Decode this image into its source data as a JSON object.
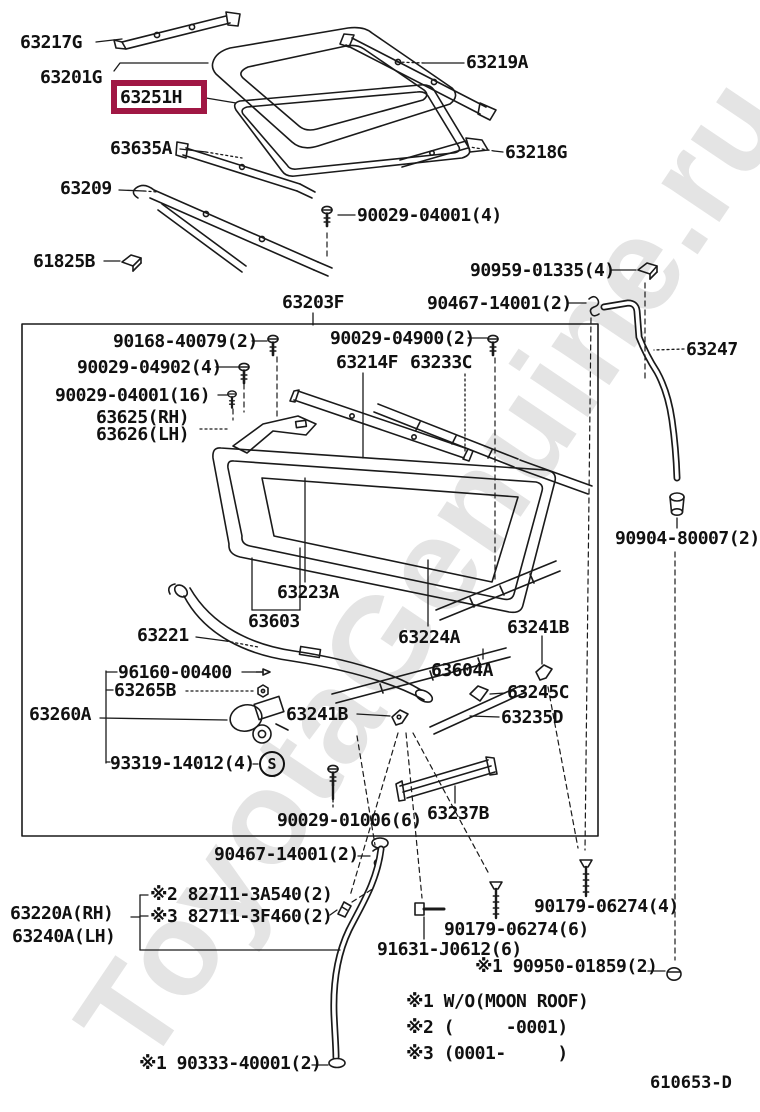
{
  "watermark": "ToyotaGenuine.ru",
  "diagram_code": "610653-D",
  "highlight": {
    "part": "63251H",
    "color": "#a01744"
  },
  "s_symbol": "S",
  "labels": [
    {
      "text": "63217G"
    },
    {
      "text": "63201G"
    },
    {
      "text": "63635A"
    },
    {
      "text": "63209"
    },
    {
      "text": "61825B"
    },
    {
      "text": "63219A"
    },
    {
      "text": "63218G"
    },
    {
      "text": "90029-04001(4)"
    },
    {
      "text": "90959-01335(4)"
    },
    {
      "text": "90467-14001(2)"
    },
    {
      "text": "63203F"
    },
    {
      "text": "63247"
    },
    {
      "text": "90168-40079(2)"
    },
    {
      "text": "90029-04900(2)"
    },
    {
      "text": "90029-04902(4)"
    },
    {
      "text": "90029-04001(16)"
    },
    {
      "text": "63214F"
    },
    {
      "text": "63233C"
    },
    {
      "text": "63625(RH)"
    },
    {
      "text": "63626(LH)"
    },
    {
      "text": "90904-80007(2)"
    },
    {
      "text": "63223A"
    },
    {
      "text": "63603"
    },
    {
      "text": "63221"
    },
    {
      "text": "63241B"
    },
    {
      "text": "63224A"
    },
    {
      "text": "96160-00400"
    },
    {
      "text": "63604A"
    },
    {
      "text": "63265B"
    },
    {
      "text": "63245C"
    },
    {
      "text": "63260A"
    },
    {
      "text": "63241B"
    },
    {
      "text": "63235D"
    },
    {
      "text": "93319-14012(4)"
    },
    {
      "text": "90029-01006(6)"
    },
    {
      "text": "63237B"
    },
    {
      "text": "90467-14001(2)"
    },
    {
      "text": "※2 82711-3A540(2)"
    },
    {
      "text": "※3 82711-3F460(2)"
    },
    {
      "text": "63220A(RH)"
    },
    {
      "text": "63240A(LH)"
    },
    {
      "text": "90179-06274(4)"
    },
    {
      "text": "90179-06274(6)"
    },
    {
      "text": "91631-J0612(6)"
    },
    {
      "text": "※1 90950-01859(2)"
    },
    {
      "text": "※1 90333-40001(2)"
    }
  ],
  "footnotes": [
    {
      "text": "※1 W/O(MOON ROOF)"
    },
    {
      "text": "※2 (     -0001)"
    },
    {
      "text": "※3 (0001-     )"
    }
  ]
}
